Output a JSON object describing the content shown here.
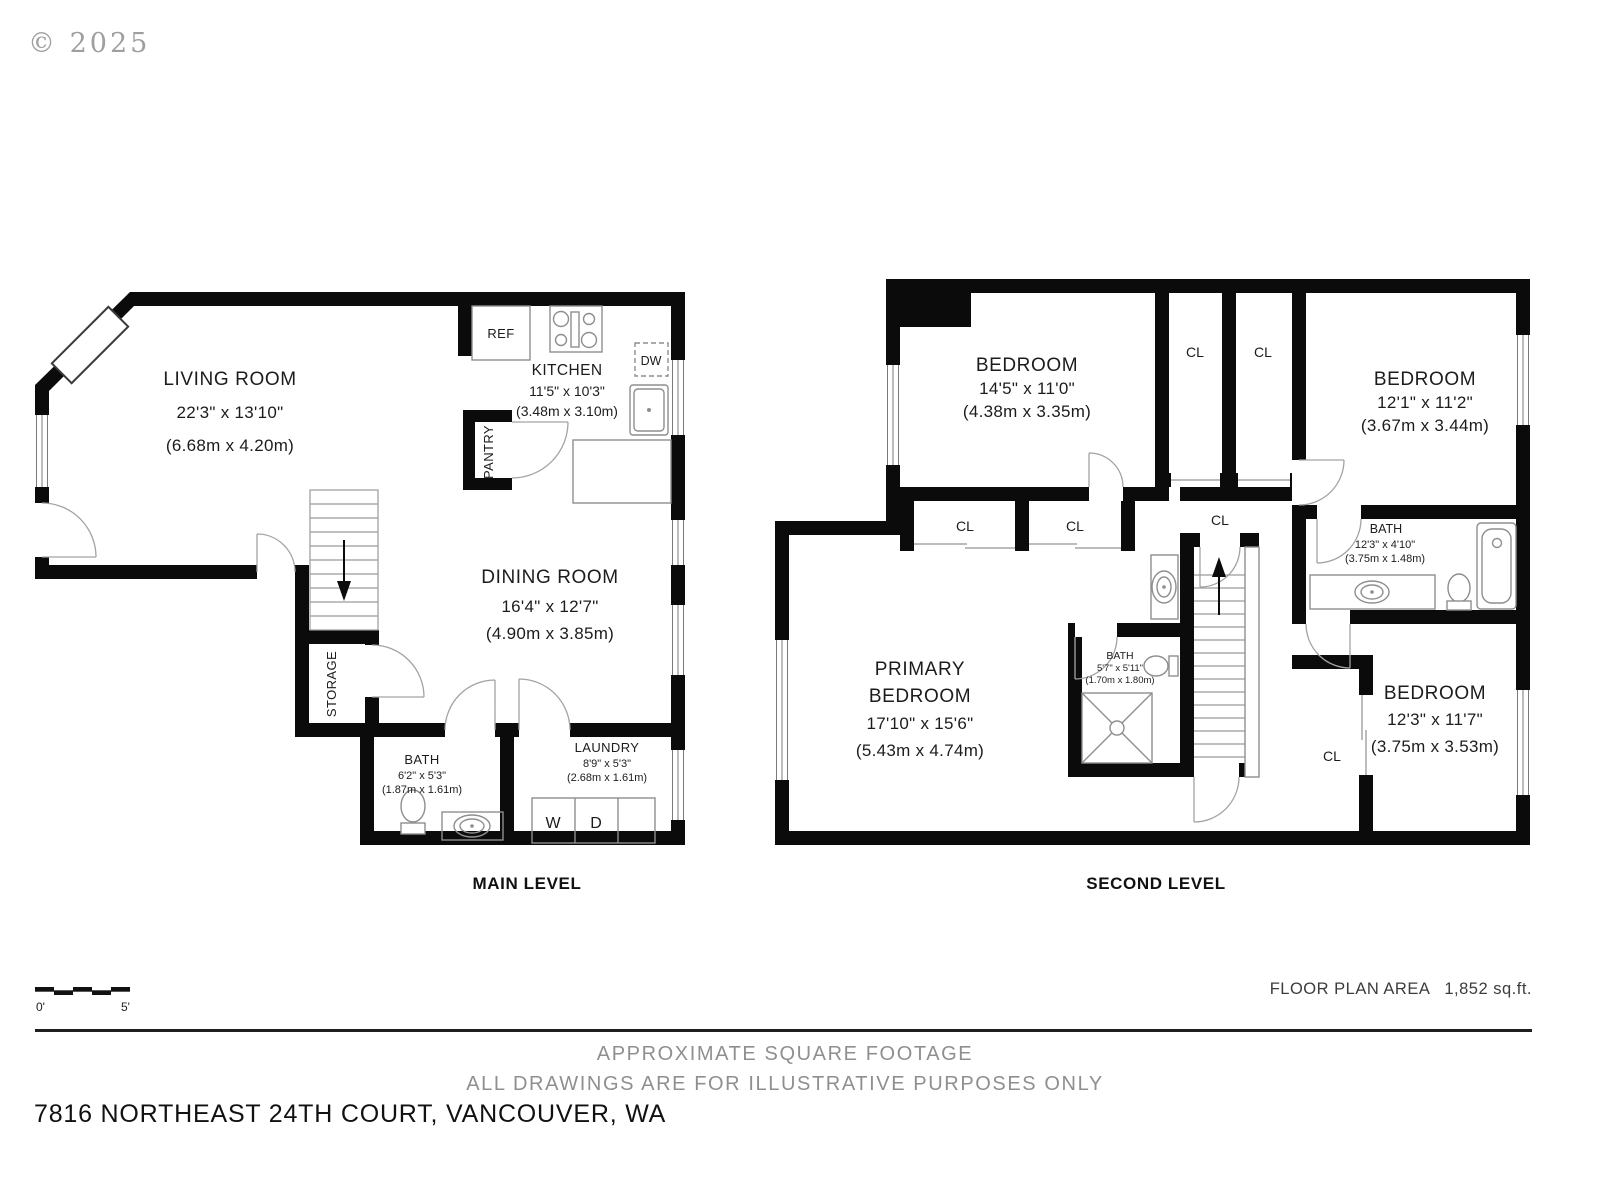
{
  "copyright": "© 2025",
  "main_level": {
    "caption": "MAIN LEVEL",
    "living_room": {
      "name": "LIVING ROOM",
      "dims_ft": "22'3\" x 13'10\"",
      "dims_m": "(6.68m x 4.20m)"
    },
    "kitchen": {
      "name": "KITCHEN",
      "dims_ft": "11'5\" x 10'3\"",
      "dims_m": "(3.48m x 3.10m)"
    },
    "dining_room": {
      "name": "DINING ROOM",
      "dims_ft": "16'4\" x 12'7\"",
      "dims_m": "(4.90m x 3.85m)"
    },
    "bath": {
      "name": "BATH",
      "dims_ft": "6'2\" x 5'3\"",
      "dims_m": "(1.87m x 1.61m)"
    },
    "laundry": {
      "name": "LAUNDRY",
      "dims_ft": "8'9\" x 5'3\"",
      "dims_m": "(2.68m x 1.61m)"
    },
    "labels": {
      "ref": "REF",
      "dw": "DW",
      "pantry": "PANTRY",
      "storage": "STORAGE",
      "washer": "W",
      "dryer": "D"
    }
  },
  "second_level": {
    "caption": "SECOND LEVEL",
    "bedroom_1": {
      "name": "BEDROOM",
      "dims_ft": "14'5\" x 11'0\"",
      "dims_m": "(4.38m x 3.35m)"
    },
    "bedroom_2": {
      "name": "BEDROOM",
      "dims_ft": "12'1\" x 11'2\"",
      "dims_m": "(3.67m x 3.44m)"
    },
    "primary_bedroom": {
      "name_line1": "PRIMARY",
      "name_line2": "BEDROOM",
      "dims_ft": "17'10\" x 15'6\"",
      "dims_m": "(5.43m x 4.74m)"
    },
    "primary_bath": {
      "name": "BATH",
      "dims_ft": "5'7\" x 5'11\"",
      "dims_m": "(1.70m x 1.80m)"
    },
    "hall_bath": {
      "name": "BATH",
      "dims_ft": "12'3\" x 4'10\"",
      "dims_m": "(3.75m x 1.48m)"
    },
    "bedroom_3": {
      "name": "BEDROOM",
      "dims_ft": "12'3\" x 11'7\"",
      "dims_m": "(3.75m x 3.53m)"
    },
    "cl_label": "CL"
  },
  "footer": {
    "scale_zero": "0'",
    "scale_five": "5'",
    "area_label": "FLOOR PLAN AREA",
    "area_value": "1,852 sq.ft.",
    "disclaimer_line1": "APPROXIMATE SQUARE FOOTAGE",
    "disclaimer_line2": "ALL DRAWINGS ARE FOR ILLUSTRATIVE PURPOSES ONLY",
    "address": "7816 NORTHEAST 24TH COURT, VANCOUVER, WA"
  },
  "colors": {
    "wall": "#0b0b0b",
    "fixture": "#8e8e8e",
    "muted_text": "#8f8f8f",
    "text": "#1c1c1c"
  }
}
